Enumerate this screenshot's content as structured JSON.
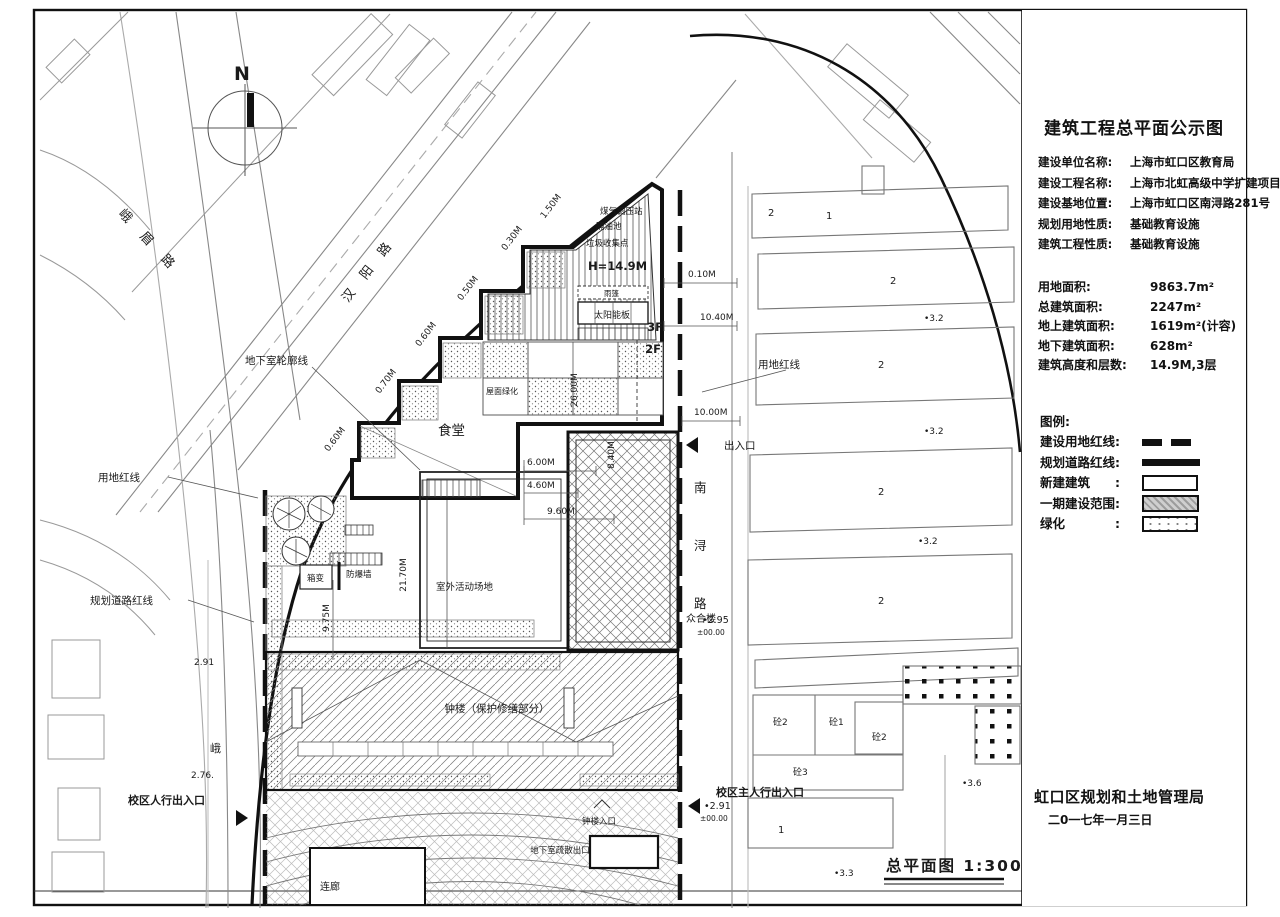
{
  "panel": {
    "title": "建筑工程总平面公示图",
    "info": [
      {
        "label": "建设单位名称:",
        "value": "上海市虹口区教育局"
      },
      {
        "label": "建设工程名称:",
        "value": "上海市北虹高级中学扩建项目"
      },
      {
        "label": "建设基地位置:",
        "value": "上海市虹口区南浔路281号"
      },
      {
        "label": "规划用地性质:",
        "value": "基础教育设施"
      },
      {
        "label": "建筑工程性质:",
        "value": "基础教育设施"
      }
    ],
    "stats": [
      {
        "label": "用地面积:",
        "value": "9863.7m²"
      },
      {
        "label": "总建筑面积:",
        "value": "2247m²"
      },
      {
        "label": "地上建筑面积:",
        "value": "1619m²(计容)"
      },
      {
        "label": "地下建筑面积:",
        "value": "628m²"
      },
      {
        "label": "建筑高度和层数:",
        "value": "14.9M,3层"
      }
    ],
    "legend_title": "图例:",
    "legend": [
      {
        "label": "建设用地红线:",
        "swatch": "dashed-line"
      },
      {
        "label": "规划道路红线:",
        "swatch": "solid-line"
      },
      {
        "label": "新建建筑　　:",
        "swatch": "white-box"
      },
      {
        "label": "一期建设范围:",
        "swatch": "hatch-box"
      },
      {
        "label": "绿化　　　　:",
        "swatch": "dot-box"
      }
    ],
    "agency": "虹口区规划和土地管理局",
    "date": "二0一七年一月三日"
  },
  "drawing": {
    "caption": "总平面图 1:300",
    "north": "N",
    "streets": {
      "hanyang": "汉阳路",
      "emei": "峨眉路",
      "emei_tail": "峨",
      "nanxun1": "南",
      "nanxun2": "浔",
      "nanxun3": "路"
    },
    "labels": {
      "gas_regulator": "煤气调压站",
      "grease_trap": "隔油池",
      "garbage_point": "垃圾收集点",
      "height": "H=14.9M",
      "canopy": "雨篷",
      "solar": "太阳能板",
      "f3": "3F",
      "f2": "2F",
      "roof_green": "屋面绿化",
      "canteen": "食堂",
      "basement_outline": "地下室轮廓线",
      "redline_left": "用地红线",
      "redline_right": "用地红线",
      "road_redline": "规划道路红线",
      "entrance": "出入口",
      "box_transformer": "箱变",
      "blast_wall": "防爆墙",
      "playground": "室外活动场地",
      "zhonghelou": "众合楼",
      "bell_tower": "钟楼（保护修缮部分）",
      "bell_entrance": "钟楼入口",
      "ped_entrance_left": "校区人行出入口",
      "ped_entrance_main": "校区主人行出入口",
      "corridor": "连廊",
      "basement_exit": "地下室疏散出口"
    },
    "dims": {
      "d1": "1.50M",
      "d2": "0.30M",
      "d3": "0.50M",
      "d4": "0.60M",
      "d5": "0.70M",
      "d6": "0.60M",
      "d7": "0.10M",
      "d8": "10.40M",
      "d9": "10.00M",
      "d10": "26.00M",
      "d11": "8.40M",
      "d12": "6.00M",
      "d13": "4.60M",
      "d14": "9.60M",
      "d15": "21.70M",
      "d16": "9.75M"
    },
    "elev": {
      "l291": "2.91",
      "l276": "2.76.",
      "r295": "•2.95",
      "pm295": "±00.00",
      "r291": "•2.91",
      "pm291": "±00.00",
      "s32a": "•3.2",
      "s32b": "•3.2",
      "s32c": "•3.2",
      "s36": "•3.6",
      "s33": "•3.3"
    },
    "nums": {
      "a2": "2",
      "a1": "1",
      "b2": "2",
      "c2": "2",
      "d2": "2",
      "e2": "2",
      "h1": "砼2",
      "h2": "砼1",
      "h3": "砼2",
      "h4": "砼3",
      "f1": "1"
    }
  }
}
